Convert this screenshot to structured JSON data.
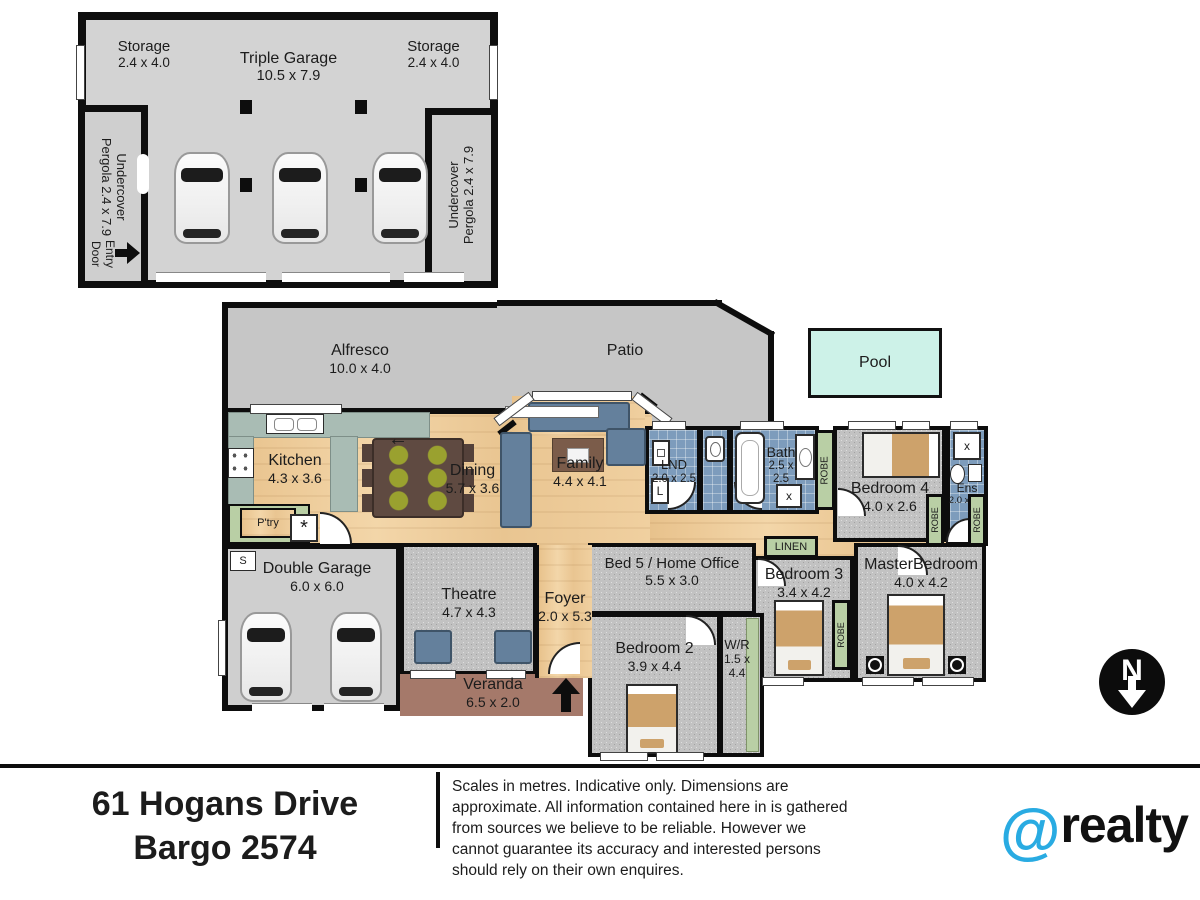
{
  "colors": {
    "wall": "#0d0d0d",
    "wood_floor": "#edca9a",
    "carpet": "#c2c2c2",
    "tile_blue": "#7d9cbc",
    "robe_green": "#b9cfa5",
    "garage_gray": "#cfcfcf",
    "outdoor_gray": "#c6c6c6",
    "veranda_brown": "#a5796a",
    "pool_cyan": "#cdf2e8",
    "brand_blue": "#29abe2"
  },
  "garage_building": {
    "storage_left": {
      "name": "Storage",
      "dims": "2.4 x 4.0"
    },
    "triple_garage": {
      "name": "Triple Garage",
      "dims": "10.5 x 7.9"
    },
    "storage_right": {
      "name": "Storage",
      "dims": "2.4 x 4.0"
    },
    "pergola_left": {
      "line1": "Undercover",
      "line2": "Pergola 2.4 x 7.9"
    },
    "pergola_right": {
      "line1": "Undercover",
      "line2": "Pergola 2.4 x 7.9"
    },
    "entry_door": {
      "line1": "Entry",
      "line2": "Door"
    }
  },
  "outdoor": {
    "alfresco": {
      "name": "Alfresco",
      "dims": "10.0 x 4.0"
    },
    "patio": {
      "name": "Patio"
    },
    "pool": {
      "name": "Pool"
    },
    "veranda": {
      "name": "Veranda",
      "dims": "6.5 x 2.0"
    }
  },
  "rooms": {
    "kitchen": {
      "name": "Kitchen",
      "dims": "4.3 x 3.6"
    },
    "dining": {
      "name": "Dining",
      "dims": "5.7 x 3.6"
    },
    "family": {
      "name": "Family",
      "dims": "4.4 x 4.1"
    },
    "lnd": {
      "name": "LND",
      "dims": "2.0 x 2.5"
    },
    "bath": {
      "name": "Bath",
      "dims": "2.5 x 2.5"
    },
    "bedroom4": {
      "name": "Bedroom 4",
      "dims": "4.0 x 2.6"
    },
    "ens": {
      "name": "Ens",
      "dims": "2.0 x 3.6"
    },
    "bed5": {
      "name": "Bed 5 / Home Office",
      "dims": "5.5 x 3.0"
    },
    "bedroom3": {
      "name": "Bedroom 3",
      "dims": "3.4 x 4.2"
    },
    "master": {
      "name": "MasterBedroom",
      "dims": "4.0 x 4.2"
    },
    "foyer": {
      "name": "Foyer",
      "dims": "2.0 x 5.3"
    },
    "theatre": {
      "name": "Theatre",
      "dims": "4.7 x 4.3"
    },
    "double_garage": {
      "name": "Double Garage",
      "dims": "6.0 x 6.0"
    },
    "bedroom2": {
      "name": "Bedroom 2",
      "dims": "3.9 x 4.4"
    },
    "wr": {
      "name": "W/R",
      "dims": "1.5 x 4.4"
    }
  },
  "labels": {
    "robe": "ROBE",
    "linen": "LINEN",
    "ptry": "P'try",
    "ovn": "OVN",
    "x_marker": "x",
    "l_marker": "L",
    "s_marker": "S",
    "asterisk": "*",
    "north": "N"
  },
  "footer": {
    "address_line1": "61 Hogans Drive",
    "address_line2": "Bargo 2574",
    "disclaimer": "Scales in metres. Indicative only. Dimensions are approximate. All information contained here in is gathered from sources we believe to be reliable. However we cannot guarantee its accuracy and interested persons should rely on their own enquires.",
    "brand_at": "@",
    "brand_name": "realty"
  }
}
